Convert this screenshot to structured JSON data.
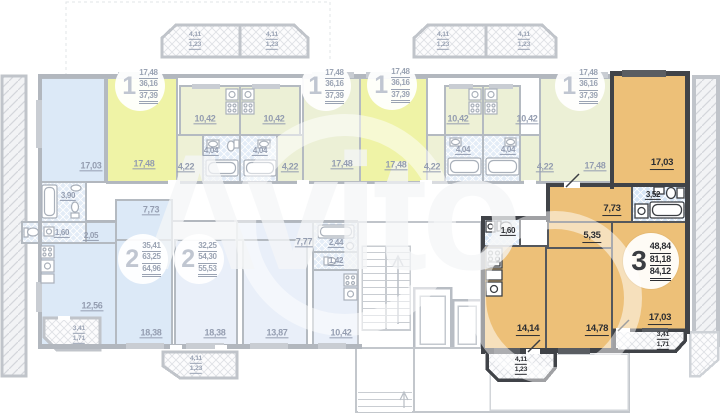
{
  "watermark": "Avito",
  "palette": {
    "highlight_orange": "#edc078",
    "unit_yellow": "#eff3a6",
    "unit_blue": "#dce9f7",
    "wall_dark": "#404348",
    "wall_light": "#b2b7be",
    "label_faded": "#949db0",
    "label_dark": "#2b2d32"
  },
  "plan": {
    "apartments": {
      "one_room": {
        "badge": "1",
        "areas": [
          "17,48",
          "36,16",
          "37,39"
        ],
        "rooms": {
          "living": "17,48",
          "kitchen": "10,42",
          "bath": "4,04",
          "hall": "4,22"
        },
        "balcony": {
          "area": "4,11",
          "reduced": "1,23"
        }
      },
      "two_room_left": {
        "badge": "2",
        "areas": [
          "35,41",
          "63,25",
          "64,96"
        ],
        "rooms": {
          "bedroom": "17,03",
          "living": "18,38",
          "kitchen": "12,56",
          "bath": "3,90",
          "wc": "1,60",
          "hall": "7,73",
          "inner_hall": "2,05"
        },
        "balcony": {
          "area": "3,41",
          "reduced": "1,71"
        }
      },
      "two_room_right": {
        "badge": "2",
        "areas": [
          "32,25",
          "54,30",
          "55,53"
        ],
        "rooms": {
          "living": "18,38",
          "bedroom": "13,87",
          "kitchen": "10,42",
          "hall": "7,77",
          "bath": "2,44",
          "wc": "1,42"
        },
        "balcony": {
          "area": "4,11",
          "reduced": "1,23"
        }
      },
      "three_room": {
        "badge": "3",
        "areas": [
          "48,84",
          "81,18",
          "84,12"
        ],
        "rooms": {
          "bedroom_top": "17,03",
          "bedroom_bottom": "17,03",
          "kitchen_living": "14,14",
          "bedroom_mid": "14,78",
          "hall": "7,73",
          "corridor": "5,35",
          "bath": "3,52",
          "wc": "1,60"
        },
        "balcony_right": {
          "area": "3,41",
          "reduced": "1,71"
        },
        "balcony_bottom": {
          "area": "4,11",
          "reduced": "1,23"
        }
      }
    }
  }
}
